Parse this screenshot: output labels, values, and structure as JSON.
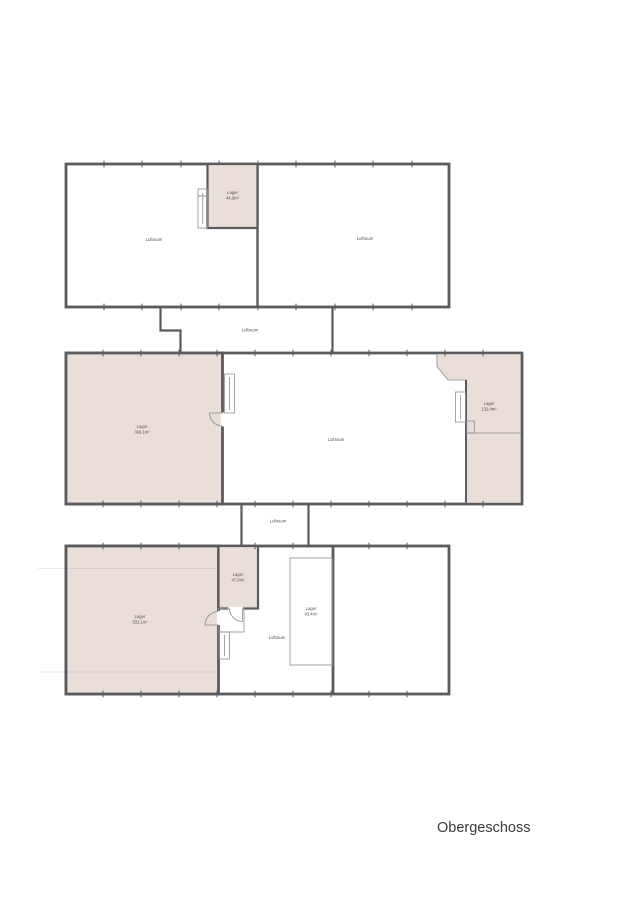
{
  "title": "Obergeschoss",
  "colors": {
    "wall": "#5b5b5f",
    "room_fill": "#e9ded8",
    "void_fill": "#ffffff",
    "background": "#ffffff"
  },
  "rooms": {
    "top_left_void": {
      "label": "Luftraum"
    },
    "top_right_void": {
      "label": "Luftraum"
    },
    "top_lager": {
      "label": "Lager",
      "area": "44,0m²"
    },
    "connector_top": {
      "label": "Luftraum"
    },
    "mid_left_lager": {
      "label": "Lager",
      "area": "399,1m²"
    },
    "mid_void": {
      "label": "Luftraum"
    },
    "mid_right_lager": {
      "label": "Lager",
      "area": "132,4m²"
    },
    "connector_bottom": {
      "label": "Luftraum"
    },
    "bottom_left_lager": {
      "label": "Lager",
      "area": "332,1m²"
    },
    "bottom_small_lager": {
      "label": "Lager",
      "area": "47,0m²"
    },
    "bottom_void": {
      "label": "Luftraum"
    },
    "bottom_platform_lager": {
      "label": "Lager",
      "area": "83,4m²"
    }
  }
}
